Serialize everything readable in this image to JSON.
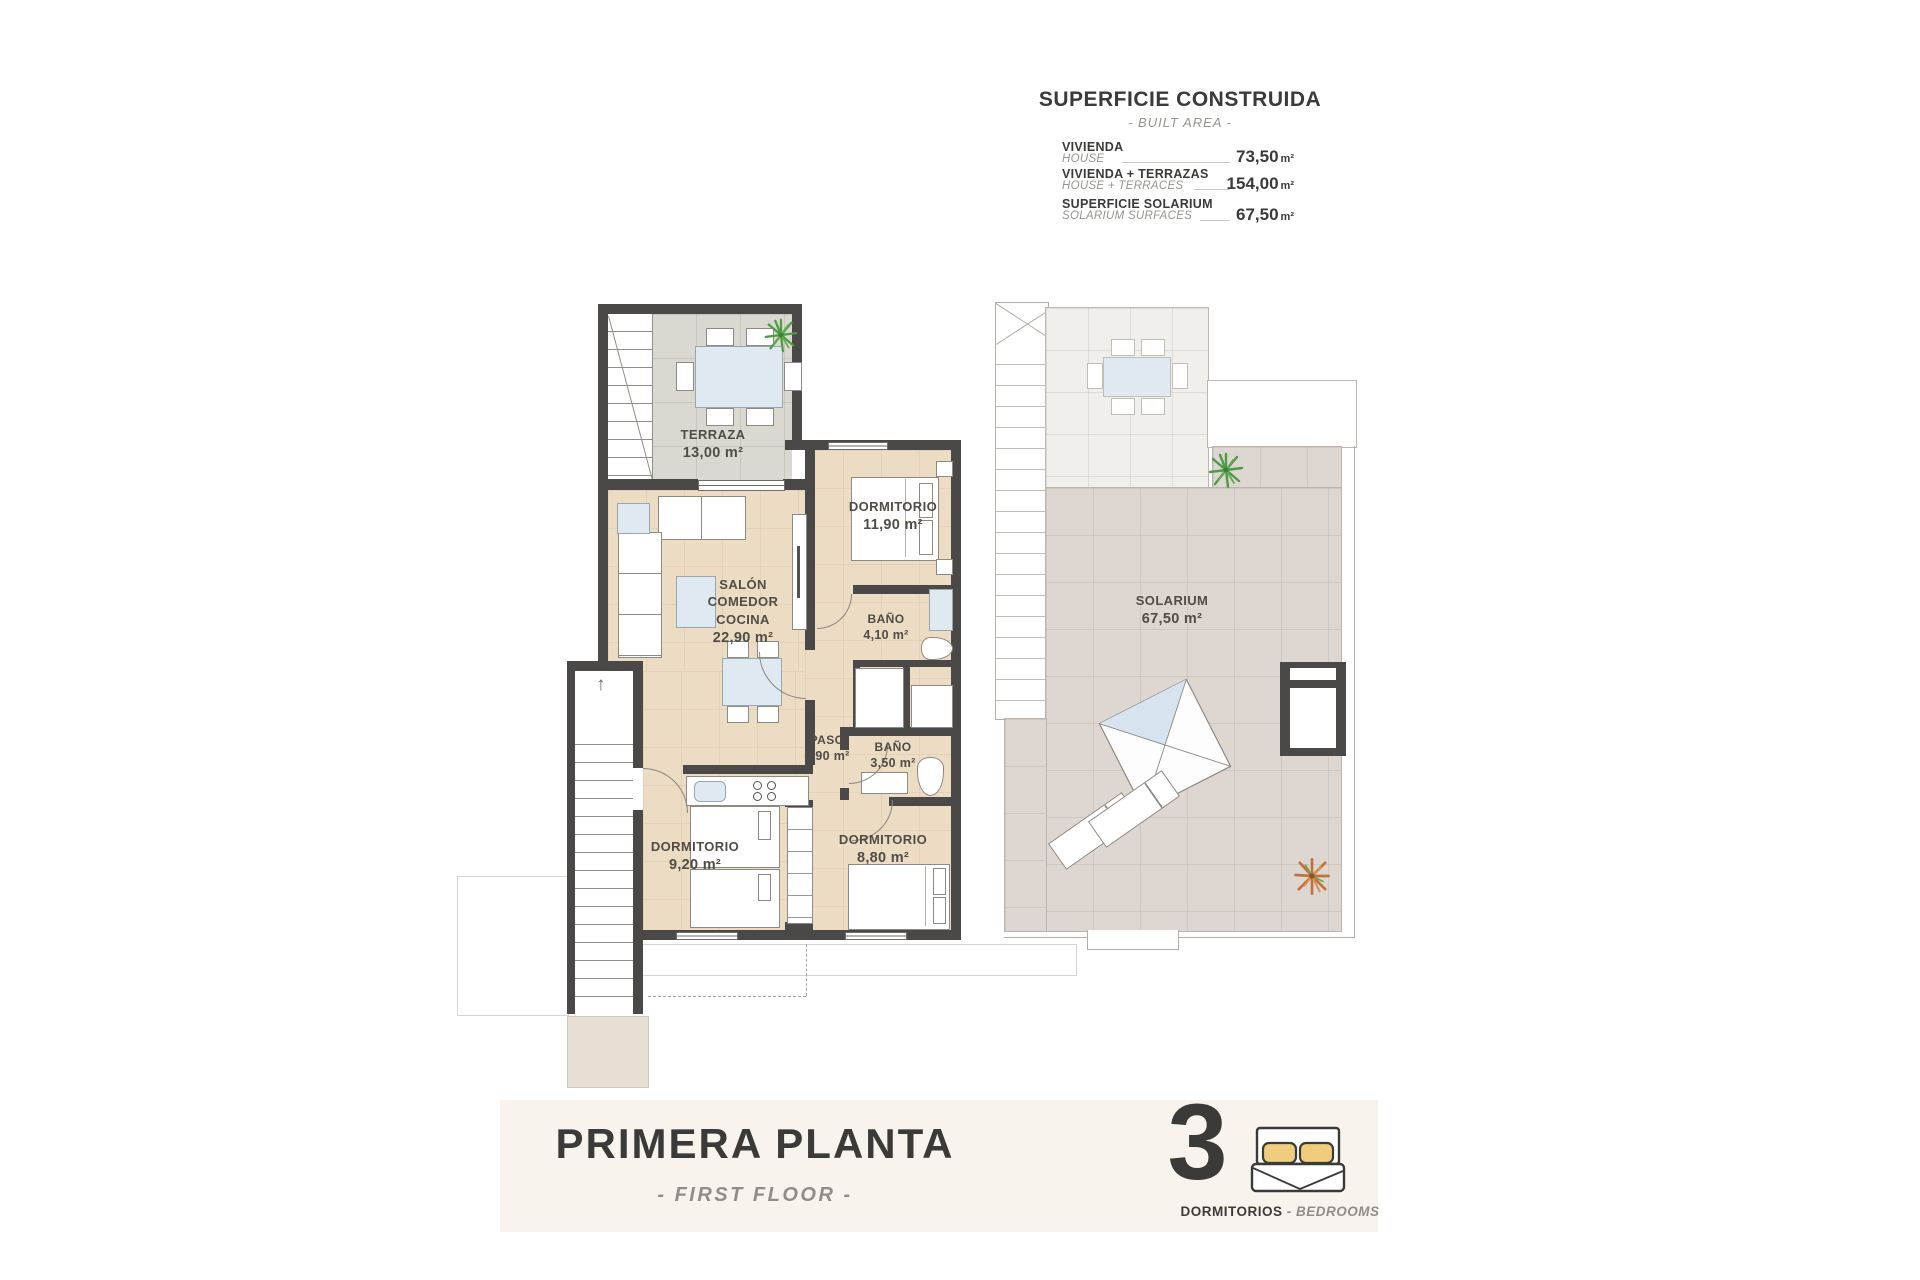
{
  "area_table": {
    "title": "SUPERFICIE CONSTRUIDA",
    "subtitle": "- BUILT AREA -",
    "rows": [
      {
        "es": "VIVIENDA",
        "en": "HOUSE",
        "value": "73,50",
        "unit": "m²"
      },
      {
        "es": "VIVIENDA + TERRAZAS",
        "en": "HOUSE + TERRACES",
        "value": "154,00",
        "unit": "m²"
      },
      {
        "es": "SUPERFICIE SOLARIUM",
        "en": "SOLARIUM SURFACES",
        "value": "67,50",
        "unit": "m²"
      }
    ]
  },
  "plan": {
    "terraza": {
      "name": "TERRAZA",
      "area": "13,00 m²"
    },
    "salon": {
      "name": "SALÓN\nCOMEDOR\nCOCINA",
      "area": "22,90 m²"
    },
    "dormitorio1": {
      "name": "DORMITORIO",
      "area": "11,90 m²"
    },
    "bano1": {
      "name": "BAÑO",
      "area": "4,10 m²"
    },
    "paso": {
      "name": "PASO",
      "area": "0,90 m²"
    },
    "bano2": {
      "name": "BAÑO",
      "area": "3,50 m²"
    },
    "dormitorio2": {
      "name": "DORMITORIO",
      "area": "9,20 m²"
    },
    "dormitorio3": {
      "name": "DORMITORIO",
      "area": "8,80 m²"
    },
    "solarium": {
      "name": "SOLARIUM",
      "area": "67,50 m²"
    }
  },
  "footer": {
    "title": "PRIMERA PLANTA",
    "subtitle": "- FIRST FLOOR -",
    "bedrooms": {
      "count": "3",
      "es": "DORMITORIOS",
      "sep": " - ",
      "en": "BEDROOMS"
    }
  },
  "colors": {
    "wall": "#4a4947",
    "floor_interior": "#ecdcc3",
    "floor_terrace": "#dbd8d1",
    "floor_solarium": "#ded6d1",
    "footer_band": "#f8f3ec",
    "furniture_blue": "#dfe9f1",
    "pillow_accent": "#f0cd7c",
    "plant_green": "#4d9b45",
    "plant_autumn": "#c1713b",
    "text_dark": "#3b3a38",
    "text_gray": "#918e89"
  }
}
